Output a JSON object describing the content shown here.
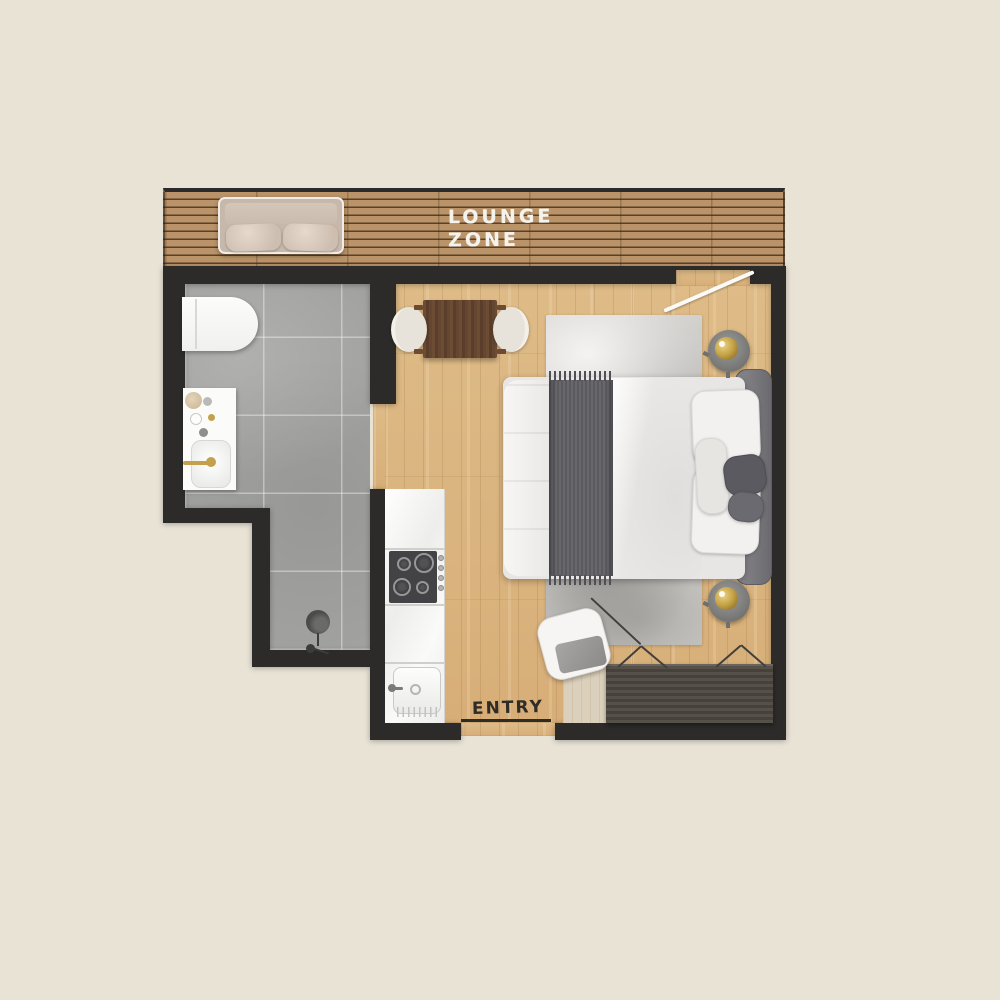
{
  "title": "Studio apartment floor plan",
  "labels": {
    "lounge_zone_line1": "LOUNGE",
    "lounge_zone_line2": "ZONE",
    "entry": "ENTRY"
  },
  "colors": {
    "background": "#e8e3d5",
    "wall": "#2c2b29",
    "deck-wood": "#bb9368",
    "floor-wood": "#dcb47e",
    "tile": "#a1a19f",
    "counter": "#f3f3f2",
    "cooktop": "#434346",
    "rug": "#d3d1ce",
    "bed-linen": "#ededeb",
    "throw": "#5f5f64",
    "headboard": "#77767a",
    "table-wood": "#64452f",
    "dresser": "#4f4944",
    "gold": "#c3a04c",
    "sofa": "#cfc1b4",
    "label-light": "#f5f3ee",
    "label-dark": "#2f2c28"
  },
  "rooms": [
    "lounge zone deck",
    "bathroom",
    "kitchen strip",
    "living and sleeping area",
    "entry"
  ],
  "furniture": [
    "outdoor sofa",
    "wall-hung toilet",
    "vanity with sink and gold faucet",
    "walk-in shower with drain",
    "kitchen counter with cooktop, knobs and sink",
    "dining table with two chairs",
    "double bed with throw and pillows",
    "area rug",
    "two round side tables with gold lamps",
    "pouf chair",
    "wardrobe dresser with door swing marks",
    "entry mat"
  ]
}
